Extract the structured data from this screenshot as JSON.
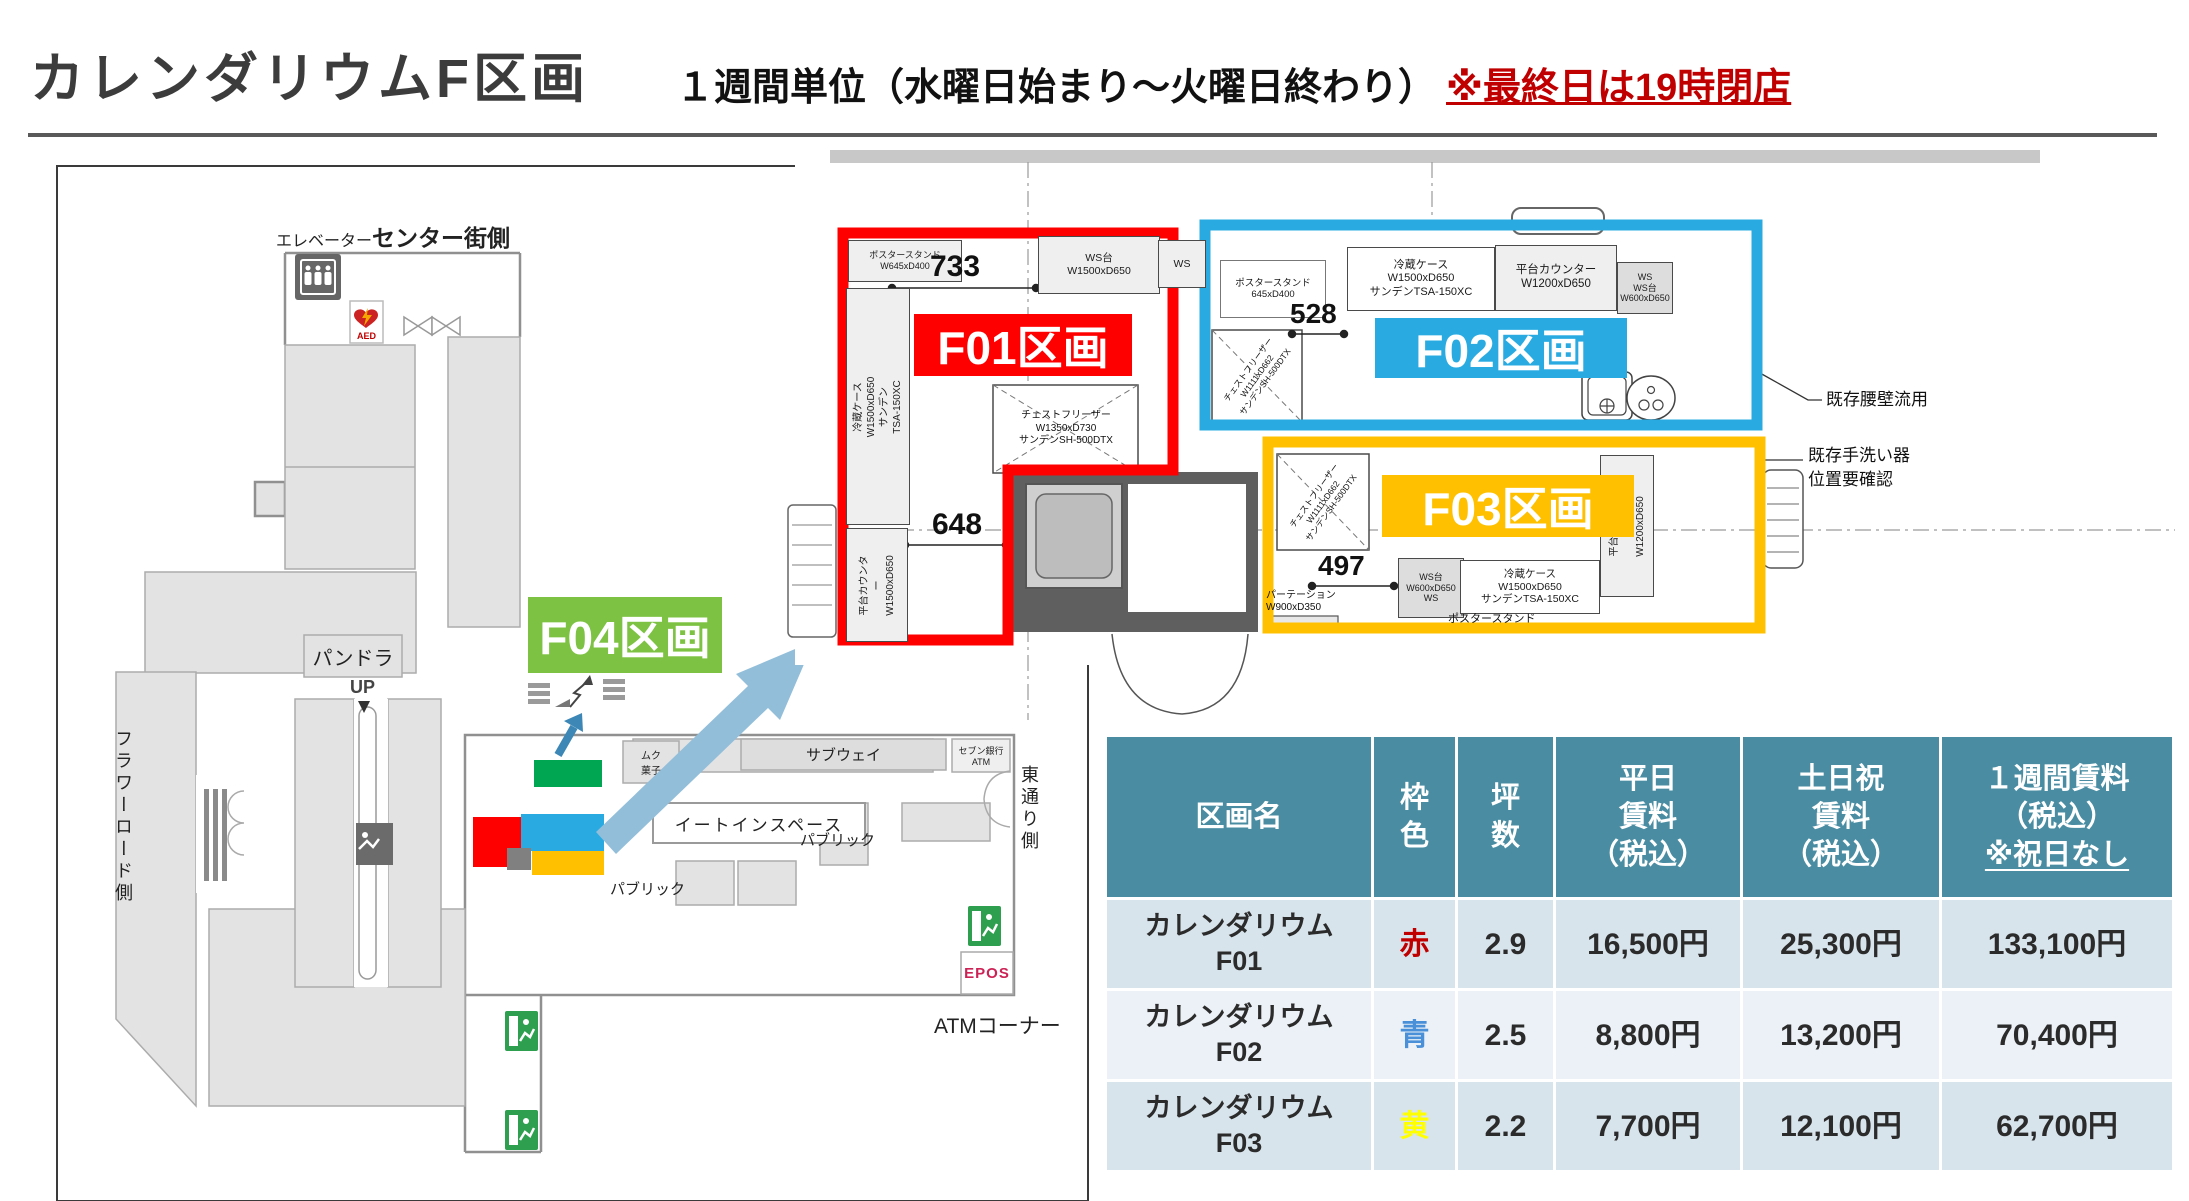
{
  "page": {
    "title": "カレンダリウムF区画",
    "subtitle": "１週間単位（水曜日始まり～火曜日終わり）",
    "subtitle_note": "※最終日は19時閉店"
  },
  "map": {
    "elevator": "エレベーター",
    "center_gai": "センター街側",
    "aed": "AED",
    "pandora": "パンドラ",
    "up": "UP",
    "flower_road": "フラワーロード側",
    "higashi_dori": "東通り側",
    "subway": "サブウェイ",
    "seven_bank": "セブン銀行\nATM",
    "eat_in": "イートインスペース",
    "public_a": "パブリック",
    "public_b": "パブリック",
    "muku": "ムク\n菓子",
    "atm_corner": "ATMコーナー",
    "epos": "EPOS",
    "markers": {
      "f01": "#ff0000",
      "f02": "#29abe2",
      "f03": "#ffc000",
      "f04": "#00a651",
      "gray": "#808080"
    }
  },
  "plan": {
    "zones": {
      "f01": {
        "label": "F01区画",
        "color": "#ff0000"
      },
      "f02": {
        "label": "F02区画",
        "color": "#29abe2"
      },
      "f03": {
        "label": "F03区画",
        "color": "#ffc000"
      },
      "f04": {
        "label": "F04区画",
        "color": "#7dc242"
      }
    },
    "dims": {
      "f01_top": "733",
      "f01_bottom": "648",
      "f02": "528",
      "f03": "497"
    },
    "eq": {
      "f01_poster": "ポスタースタンド\nW645xD400",
      "f01_ws_dai": "WS台\nW1500xD650",
      "f01_ws": "WS",
      "f01_reizo": "冷蔵ケース\nW1500xD650\nサンデンTSA-150XC",
      "f01_chest": "チェストフリーザー\nW1350xD730\nサンデンSH-500DTX",
      "f01_hiradai": "平台カウンター\nW1500xD650",
      "f02_poster": "ポスタースタンド\n645xD400",
      "f02_chest": "チェストフリーザー\nW1111xD662\nサンデンSH-500DTX",
      "f02_reizo": "冷蔵ケース\nW1500xD650\nサンデンTSA-150XC",
      "f02_hiradai": "平台カウンター\nW1200xD650",
      "f02_ws": "WS\nWS台\nW600xD650",
      "f03_chest": "チェストフリーザー\nW1111xD662\nサンデンSH-500DTX",
      "f03_ws": "WS台\nW600xD650\nWS",
      "f03_reizo": "冷蔵ケース\nW1500xD650\nサンデンTSA-150XC",
      "f03_hiradai": "平台カウンター\nW1200xD650",
      "f03_partition": "パーテーション\nW900xD350",
      "f03_poster": "ポスタースタンド"
    },
    "annotations": {
      "koshikabe": "既存腰壁流用",
      "tearai": "既存手洗い器\n位置要確認"
    }
  },
  "table": {
    "colors": {
      "header_bg": "#4a8da3",
      "row_odd": "#d8e4ec",
      "row_even": "#ebf1f6"
    },
    "headers": {
      "name": {
        "lines": [
          "区画名"
        ]
      },
      "frame": {
        "lines": [
          "枠",
          "色"
        ]
      },
      "tsubo": {
        "lines": [
          "坪",
          "数"
        ]
      },
      "weekday": {
        "lines": [
          "平日",
          "賃料",
          "（税込）"
        ]
      },
      "weekend": {
        "lines": [
          "土日祝",
          "賃料",
          "（税込）"
        ]
      },
      "week": {
        "lines": [
          "１週間賃料",
          "（税込）",
          "※祝日なし"
        ]
      }
    },
    "rows": [
      {
        "name": [
          "カレンダリウム",
          "F01"
        ],
        "frame": "赤",
        "frame_hex": "#c00000",
        "tsubo": "2.9",
        "weekday": "16,500円",
        "weekend": "25,300円",
        "week": "133,100円"
      },
      {
        "name": [
          "カレンダリウム",
          "F02"
        ],
        "frame": "青",
        "frame_hex": "#4a90d9",
        "tsubo": "2.5",
        "weekday": "8,800円",
        "weekend": "13,200円",
        "week": "70,400円"
      },
      {
        "name": [
          "カレンダリウム",
          "F03"
        ],
        "frame": "黄",
        "frame_hex": "#ffff00",
        "tsubo": "2.2",
        "weekday": "7,700円",
        "weekend": "12,100円",
        "week": "62,700円"
      }
    ]
  }
}
